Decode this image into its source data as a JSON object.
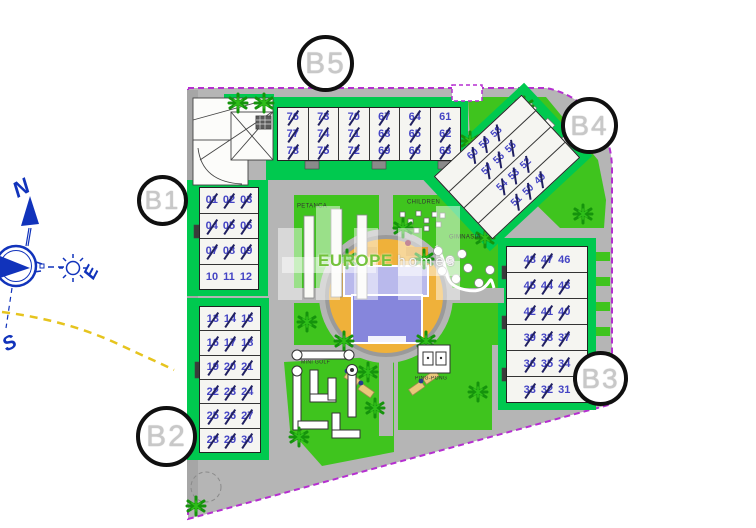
{
  "watermark": {
    "brand_bold": "EUROPE",
    "brand_light": "homes"
  },
  "compass": {
    "north": "N",
    "east": "E",
    "south": "S"
  },
  "badges": [
    {
      "label": "B1"
    },
    {
      "label": "B2"
    },
    {
      "label": "B3"
    },
    {
      "label": "B4"
    },
    {
      "label": "B5"
    }
  ],
  "areas": {
    "petanca": "PETANCA",
    "children": "CHILDREN",
    "gym": "GIMNASIA",
    "pingpong": "PING-PONG",
    "minigolf": "MINI GOLF"
  },
  "icons": {
    "compass": "compass-rose-icon",
    "sun": "sun-icon",
    "tree": "tree-icon",
    "pingpong_table": "ping-pong-table-icon"
  },
  "colors": {
    "boundary": "#b52fd0",
    "grass": "#3fc41e",
    "building_pad": "#00c94f",
    "path_gray": "#b5b5b5",
    "unit_number": "#4444c4",
    "sold_strike": "#202060",
    "pool_deck": "#efb13a",
    "pool_water": "#8686dc",
    "compass_blue": "#1133bb",
    "sun_path_yellow": "#e6c41e"
  },
  "blocks": {
    "b5": {
      "groups": [
        [
          {
            "n": "76",
            "sold": true
          },
          {
            "n": "77",
            "sold": true
          },
          {
            "n": "78",
            "sold": true
          }
        ],
        [
          {
            "n": "73",
            "sold": true
          },
          {
            "n": "74",
            "sold": true
          },
          {
            "n": "75",
            "sold": true
          }
        ],
        [
          {
            "n": "70",
            "sold": true
          },
          {
            "n": "71",
            "sold": true
          },
          {
            "n": "72",
            "sold": true
          }
        ],
        [
          {
            "n": "67",
            "sold": true
          },
          {
            "n": "68",
            "sold": true
          },
          {
            "n": "69",
            "sold": true
          }
        ],
        [
          {
            "n": "64",
            "sold": true
          },
          {
            "n": "65",
            "sold": true
          },
          {
            "n": "66",
            "sold": true
          }
        ],
        [
          {
            "n": "61",
            "sold": false
          },
          {
            "n": "62",
            "sold": true
          },
          {
            "n": "63",
            "sold": true
          }
        ]
      ]
    },
    "b1": {
      "groups": [
        [
          {
            "n": "01",
            "sold": true
          },
          {
            "n": "02",
            "sold": true
          },
          {
            "n": "03",
            "sold": true
          }
        ],
        [
          {
            "n": "04",
            "sold": true
          },
          {
            "n": "05",
            "sold": true
          },
          {
            "n": "06",
            "sold": true
          }
        ],
        [
          {
            "n": "07",
            "sold": true
          },
          {
            "n": "08",
            "sold": true
          },
          {
            "n": "09",
            "sold": true
          }
        ],
        [
          {
            "n": "10",
            "sold": false
          },
          {
            "n": "11",
            "sold": false
          },
          {
            "n": "12",
            "sold": false
          }
        ]
      ]
    },
    "b2": {
      "groups": [
        [
          {
            "n": "13",
            "sold": true
          },
          {
            "n": "14",
            "sold": true
          },
          {
            "n": "15",
            "sold": true
          }
        ],
        [
          {
            "n": "16",
            "sold": true
          },
          {
            "n": "17",
            "sold": true
          },
          {
            "n": "18",
            "sold": true
          }
        ],
        [
          {
            "n": "19",
            "sold": true
          },
          {
            "n": "20",
            "sold": true
          },
          {
            "n": "21",
            "sold": true
          }
        ],
        [
          {
            "n": "22",
            "sold": true
          },
          {
            "n": "23",
            "sold": true
          },
          {
            "n": "24",
            "sold": true
          }
        ],
        [
          {
            "n": "25",
            "sold": true
          },
          {
            "n": "26",
            "sold": true
          },
          {
            "n": "27",
            "sold": true
          }
        ],
        [
          {
            "n": "28",
            "sold": true
          },
          {
            "n": "29",
            "sold": true
          },
          {
            "n": "30",
            "sold": true
          }
        ]
      ]
    },
    "b3": {
      "groups": [
        [
          {
            "n": "48",
            "sold": true
          },
          {
            "n": "47",
            "sold": true
          },
          {
            "n": "46",
            "sold": false
          }
        ],
        [
          {
            "n": "45",
            "sold": true
          },
          {
            "n": "44",
            "sold": true
          },
          {
            "n": "43",
            "sold": true
          }
        ],
        [
          {
            "n": "42",
            "sold": true
          },
          {
            "n": "41",
            "sold": true
          },
          {
            "n": "40",
            "sold": true
          }
        ],
        [
          {
            "n": "39",
            "sold": true
          },
          {
            "n": "38",
            "sold": true
          },
          {
            "n": "37",
            "sold": true
          }
        ],
        [
          {
            "n": "36",
            "sold": true
          },
          {
            "n": "35",
            "sold": true
          },
          {
            "n": "34",
            "sold": true
          }
        ],
        [
          {
            "n": "33",
            "sold": true
          },
          {
            "n": "32",
            "sold": true
          },
          {
            "n": "31",
            "sold": false
          }
        ]
      ]
    },
    "b4": {
      "groups": [
        [
          {
            "n": "60",
            "sold": true
          },
          {
            "n": "59",
            "sold": true
          },
          {
            "n": "58",
            "sold": true
          }
        ],
        [
          {
            "n": "57",
            "sold": true
          },
          {
            "n": "56",
            "sold": true
          },
          {
            "n": "55",
            "sold": true
          }
        ],
        [
          {
            "n": "54",
            "sold": true
          },
          {
            "n": "53",
            "sold": true
          },
          {
            "n": "52",
            "sold": true
          }
        ],
        [
          {
            "n": "51",
            "sold": true
          },
          {
            "n": "50",
            "sold": true
          },
          {
            "n": "49",
            "sold": true
          }
        ]
      ]
    }
  }
}
